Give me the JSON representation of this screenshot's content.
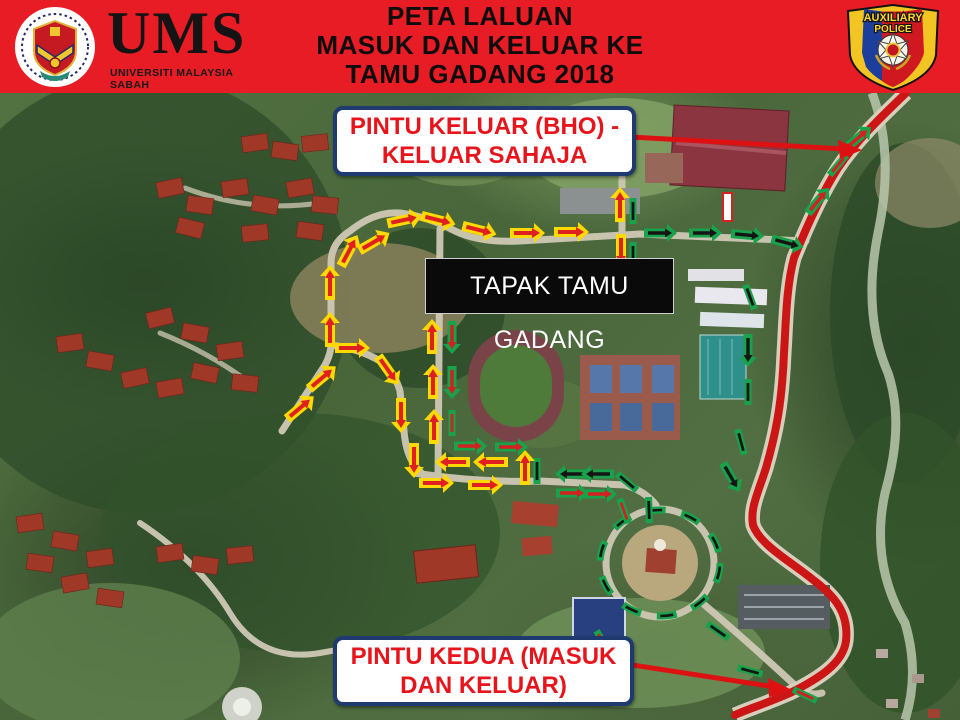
{
  "header": {
    "title_line1": "PETA LALUAN",
    "title_line2": "MASUK DAN KELUAR KE",
    "title_line3": "TAMU GADANG 2018",
    "bg_color": "#e81c24",
    "ums": {
      "acronym": "UMS",
      "name": "UNIVERSITI MALAYSIA SABAH"
    },
    "police": {
      "arc_top": "AUXILIARY",
      "arc_bottom": "POLICE"
    }
  },
  "map": {
    "labels": {
      "exit_gate_line1": "PINTU KELUAR (BHO) -",
      "exit_gate_line2": "KELUAR SAHAJA",
      "site": "TAPAK TAMU GADANG",
      "second_gate_line1": "PINTU KEDUA (MASUK",
      "second_gate_line2": "DAN KELUAR)"
    },
    "colors": {
      "label_text": "#e8141c",
      "label_border": "#1f3a6e",
      "entry_arrow_yellow": "#ffd900",
      "arrow_core_red": "#e02020",
      "exit_dash_green": "#17a24b",
      "main_road_red": "#cc1616"
    }
  }
}
